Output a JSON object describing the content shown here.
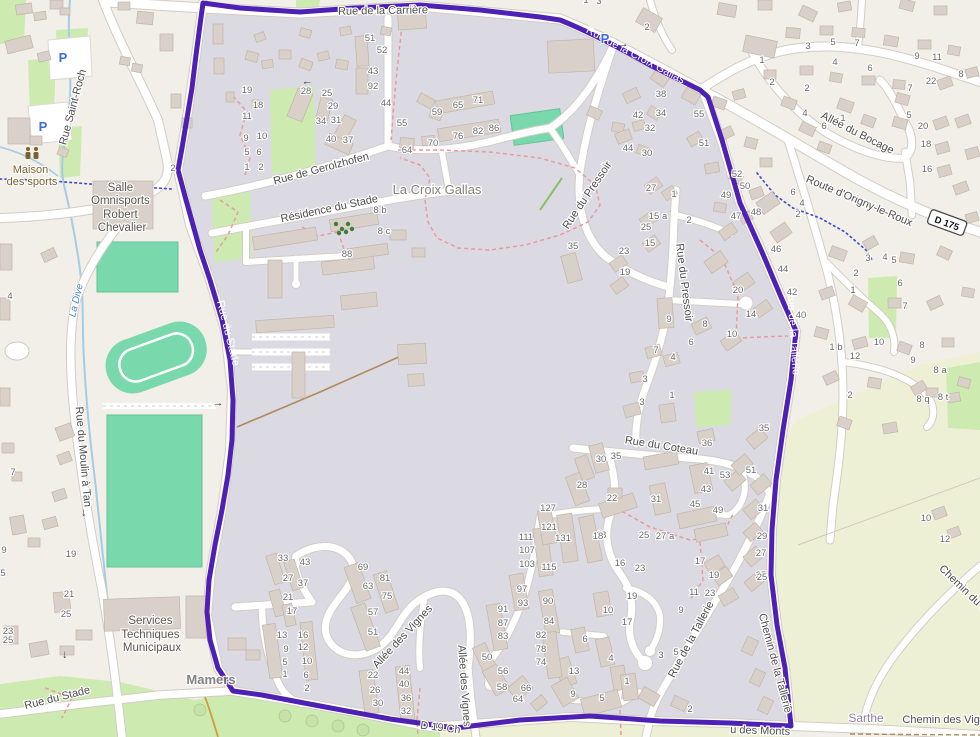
{
  "map": {
    "title": "Carte OpenStreetMap - Mamers, limite communale surlignée",
    "colors": {
      "land": "#f2efe9",
      "residential": "#dbdae2",
      "farmland": "#eef0d5",
      "grass": "#cdebb0",
      "pitch": "#79d9ad",
      "pitch_edge": "#62c296",
      "building": "#d9d0c9",
      "building_edge": "#c3b5a6",
      "road": "#ffffff",
      "road_casing": "#d2cdc4",
      "boundary": "#4e21b4",
      "water": "#a6cbe4",
      "footpath_red": "#ea9a9a",
      "admin_blue": "#4050cc",
      "track_brown": "#b08a5a",
      "path_ochre": "#cf9e3e",
      "number": "#6b6b6b",
      "street_text": "#4d4d4d",
      "tree_dark": "#3f7d36",
      "tree_pale": "#c8e0aa"
    },
    "road_ref": {
      "text": "D 175",
      "x": 947,
      "y": 223,
      "rot": 20
    },
    "place_label": {
      "text": "La Croix Gallas",
      "x": 437,
      "y": 194
    },
    "admin_labels": [
      {
        "text": "Mamers",
        "x": 211,
        "y": 684
      },
      {
        "text": "Sarthe",
        "x": 866,
        "y": 722
      }
    ],
    "water_label": {
      "text": "La Dive",
      "x": 79,
      "y": 301,
      "rot": -77
    },
    "poi": {
      "maison_sports": {
        "lines": [
          "Maison",
          "des sports"
        ],
        "x": 32,
        "ys": [
          173,
          185
        ]
      },
      "salle_omnisports": {
        "lines": [
          "Salle",
          "Omnisports",
          "Robert",
          "Chevalier"
        ],
        "x": 122,
        "ys": [
          191,
          204,
          218,
          231
        ]
      },
      "services_techniques": {
        "lines": [
          "Services",
          "Techniques",
          "Municipaux"
        ],
        "x": 152,
        "ys": [
          624,
          638,
          651
        ]
      }
    },
    "street_labels": [
      {
        "text": "Rue de la Carrière",
        "x": 383,
        "y": 14,
        "r": -1
      },
      {
        "text": "Rue de la Croix Gallas",
        "x": 634,
        "y": 58,
        "r": 28,
        "c": "white"
      },
      {
        "text": "Rue Saint-Roch",
        "x": 76,
        "y": 108,
        "r": -75
      },
      {
        "text": "Allée du Bocage",
        "x": 856,
        "y": 136,
        "r": 27
      },
      {
        "text": "Route d'Origny-le-Roux",
        "x": 858,
        "y": 204,
        "r": 23
      },
      {
        "text": "Rue de Gerolzhofen",
        "x": 322,
        "y": 172,
        "r": -15
      },
      {
        "text": "Résidence du Stade",
        "x": 330,
        "y": 212,
        "r": -12
      },
      {
        "text": "Rue du Pressoir",
        "x": 590,
        "y": 197,
        "r": -56
      },
      {
        "text": "Rue du Pressoir",
        "x": 681,
        "y": 283,
        "r": 83
      },
      {
        "text": "Rue du Coteau",
        "x": 661,
        "y": 449,
        "r": 9
      },
      {
        "text": "Rue de la Tallerie",
        "x": 790,
        "y": 333,
        "r": 86,
        "c": "white"
      },
      {
        "text": "Rue de la Tallerie",
        "x": 694,
        "y": 641,
        "r": -62
      },
      {
        "text": "Chemin de la Tallerie",
        "x": 772,
        "y": 664,
        "r": 75
      },
      {
        "text": "Allée des Vignes",
        "x": 405,
        "y": 639,
        "r": -47
      },
      {
        "text": "Allée des Vignes",
        "x": 461,
        "y": 686,
        "r": 86
      },
      {
        "text": "Rue du Moulin à Tan",
        "x": 80,
        "y": 457,
        "r": 85
      },
      {
        "text": "Rue du Stade",
        "x": 225,
        "y": 334,
        "r": 76,
        "c": "white"
      },
      {
        "text": "Rue du Stade",
        "x": 58,
        "y": 701,
        "r": -14
      },
      {
        "text": "Chemin des Vignes",
        "x": 950,
        "y": 723,
        "r": 0
      },
      {
        "text": "Chemin du M",
        "x": 962,
        "y": 592,
        "r": 44
      },
      {
        "text": "D 19 Ch",
        "x": 440,
        "y": 731,
        "r": 7
      },
      {
        "text": "u des Monts",
        "x": 760,
        "y": 734,
        "r": 2
      }
    ],
    "parking_icons": [
      {
        "x": 63,
        "y": 62
      },
      {
        "x": 43,
        "y": 131
      },
      {
        "x": 605,
        "y": 43
      }
    ],
    "oneway_arrows": [
      {
        "x": 307,
        "y": 81,
        "r": 180
      },
      {
        "x": 623,
        "y": 47,
        "r": 0
      },
      {
        "x": 82,
        "y": 513,
        "r": 90
      },
      {
        "x": 63,
        "y": 655,
        "r": 90
      },
      {
        "x": 218,
        "y": 406,
        "r": 0
      }
    ],
    "house_numbers": [
      [
        "19",
        247,
        93
      ],
      [
        "18",
        258,
        108
      ],
      [
        "11",
        247,
        119
      ],
      [
        "9",
        246,
        141
      ],
      [
        "10",
        262,
        139
      ],
      [
        "5",
        247,
        155
      ],
      [
        "6",
        259,
        155
      ],
      [
        "1",
        247,
        170
      ],
      [
        "2",
        261,
        170
      ],
      [
        "28",
        306,
        94
      ],
      [
        "25",
        327,
        96
      ],
      [
        "29",
        333,
        109
      ],
      [
        "34",
        321,
        124
      ],
      [
        "31",
        336,
        123
      ],
      [
        "40",
        331,
        142
      ],
      [
        "37",
        348,
        143
      ],
      [
        "51",
        370,
        41
      ],
      [
        "52",
        382,
        53
      ],
      [
        "43",
        373,
        74
      ],
      [
        "92",
        373,
        89
      ],
      [
        "44",
        386,
        106
      ],
      [
        "55",
        402,
        126
      ],
      [
        "64",
        407,
        153
      ],
      [
        "70",
        433,
        146
      ],
      [
        "76",
        458,
        139
      ],
      [
        "82",
        478,
        134
      ],
      [
        "86",
        494,
        131
      ],
      [
        "59",
        437,
        115
      ],
      [
        "65",
        458,
        108
      ],
      [
        "71",
        478,
        103
      ],
      [
        "1",
        586,
        3
      ],
      [
        "3",
        599,
        4
      ],
      [
        "2",
        647,
        30
      ],
      [
        "1",
        762,
        63
      ],
      [
        "2",
        772,
        85
      ],
      [
        "2",
        173,
        171
      ],
      [
        "38",
        661,
        97
      ],
      [
        "42",
        638,
        118
      ],
      [
        "34",
        661,
        116
      ],
      [
        "32",
        650,
        131
      ],
      [
        "44",
        628,
        151
      ],
      [
        "30",
        647,
        156
      ],
      [
        "55",
        699,
        117
      ],
      [
        "51",
        704,
        146
      ],
      [
        "52",
        737,
        177
      ],
      [
        "50",
        745,
        189
      ],
      [
        "49",
        726,
        198
      ],
      [
        "47",
        736,
        219
      ],
      [
        "48",
        756,
        215
      ],
      [
        "46",
        776,
        252
      ],
      [
        "44",
        783,
        272
      ],
      [
        "42",
        792,
        295
      ],
      [
        "40",
        801,
        318
      ],
      [
        "3",
        808,
        49
      ],
      [
        "5",
        833,
        45
      ],
      [
        "7",
        857,
        46
      ],
      [
        "9",
        917,
        59
      ],
      [
        "11",
        937,
        60
      ],
      [
        "4",
        835,
        65
      ],
      [
        "6",
        870,
        71
      ],
      [
        "8",
        961,
        77
      ],
      [
        "2",
        807,
        91
      ],
      [
        "22",
        931,
        84
      ],
      [
        "7",
        910,
        91
      ],
      [
        "4",
        805,
        116
      ],
      [
        "1",
        843,
        121
      ],
      [
        "5",
        909,
        118
      ],
      [
        "6",
        824,
        129
      ],
      [
        "20",
        923,
        129
      ],
      [
        "18",
        926,
        147
      ],
      [
        "16",
        927,
        172
      ],
      [
        "3",
        868,
        261
      ],
      [
        "4",
        885,
        260
      ],
      [
        "5",
        894,
        263
      ],
      [
        "2",
        856,
        276
      ],
      [
        "1",
        853,
        293
      ],
      [
        "6",
        793,
        195
      ],
      [
        "4",
        802,
        206
      ],
      [
        "2",
        798,
        217
      ],
      [
        "6",
        900,
        286
      ],
      [
        "7",
        905,
        309
      ],
      [
        "8",
        922,
        348
      ],
      [
        "9",
        913,
        363
      ],
      [
        "8 a",
        940,
        373
      ],
      [
        "8 q",
        923,
        402
      ],
      [
        "8 t",
        943,
        400
      ],
      [
        "1 b",
        836,
        350
      ],
      [
        "10",
        879,
        345
      ],
      [
        "12",
        855,
        359
      ],
      [
        "2",
        850,
        398
      ],
      [
        "10",
        926,
        521
      ],
      [
        "12",
        945,
        542
      ],
      [
        "25",
        761,
        578
      ],
      [
        "27",
        651,
        191
      ],
      [
        "1",
        674,
        197
      ],
      [
        "15 a",
        658,
        219
      ],
      [
        "25",
        646,
        230
      ],
      [
        "15",
        650,
        246
      ],
      [
        "23",
        624,
        254
      ],
      [
        "19",
        625,
        275
      ],
      [
        "35",
        573,
        249
      ],
      [
        "2",
        689,
        223
      ],
      [
        "20",
        738,
        293
      ],
      [
        "14",
        751,
        317
      ],
      [
        "10",
        732,
        337
      ],
      [
        "9",
        669,
        322
      ],
      [
        "8",
        705,
        327
      ],
      [
        "7",
        656,
        353
      ],
      [
        "4",
        673,
        360
      ],
      [
        "6",
        691,
        345
      ],
      [
        "3",
        645,
        382
      ],
      [
        "3",
        642,
        405
      ],
      [
        "1",
        672,
        398
      ],
      [
        "30",
        601,
        462
      ],
      [
        "35",
        616,
        459
      ],
      [
        "36",
        707,
        446
      ],
      [
        "41",
        709,
        474
      ],
      [
        "53",
        725,
        478
      ],
      [
        "51",
        751,
        473
      ],
      [
        "43",
        706,
        492
      ],
      [
        "35",
        764,
        431
      ],
      [
        "28",
        582,
        488
      ],
      [
        "22",
        612,
        501
      ],
      [
        "31",
        656,
        502
      ],
      [
        "45",
        695,
        507
      ],
      [
        "49",
        718,
        513
      ],
      [
        "31",
        763,
        511
      ],
      [
        "29",
        762,
        539
      ],
      [
        "27",
        761,
        556
      ],
      [
        "25",
        762,
        580
      ],
      [
        "18",
        601,
        538
      ],
      [
        "16",
        620,
        566
      ],
      [
        "25",
        644,
        538
      ],
      [
        "27 a",
        665,
        539
      ],
      [
        "23",
        640,
        571
      ],
      [
        "17",
        700,
        564
      ],
      [
        "19",
        714,
        578
      ],
      [
        "11",
        694,
        595
      ],
      [
        "23",
        710,
        596
      ],
      [
        "19",
        632,
        599
      ],
      [
        "10",
        608,
        613
      ],
      [
        "17",
        627,
        625
      ],
      [
        "33",
        283,
        561
      ],
      [
        "43",
        305,
        565
      ],
      [
        "27",
        288,
        581
      ],
      [
        "37",
        303,
        586
      ],
      [
        "21",
        288,
        600
      ],
      [
        "17",
        292,
        614
      ],
      [
        "69",
        363,
        570
      ],
      [
        "63",
        368,
        589
      ],
      [
        "81",
        385,
        581
      ],
      [
        "75",
        387,
        599
      ],
      [
        "57",
        373,
        615
      ],
      [
        "51",
        373,
        635
      ],
      [
        "13",
        282,
        638
      ],
      [
        "16",
        303,
        638
      ],
      [
        "9",
        286,
        652
      ],
      [
        "12",
        303,
        650
      ],
      [
        "5",
        285,
        665
      ],
      [
        "10",
        307,
        664
      ],
      [
        "1",
        285,
        677
      ],
      [
        "6",
        306,
        678
      ],
      [
        "2",
        307,
        691
      ],
      [
        "22",
        373,
        678
      ],
      [
        "26",
        375,
        693
      ],
      [
        "30",
        378,
        706
      ],
      [
        "44",
        404,
        674
      ],
      [
        "40",
        404,
        687
      ],
      [
        "36",
        406,
        701
      ],
      [
        "32",
        406,
        714
      ],
      [
        "127",
        548,
        511
      ],
      [
        "121",
        549,
        530
      ],
      [
        "111",
        526,
        540
      ],
      [
        "131",
        563,
        541
      ],
      [
        "107",
        527,
        553
      ],
      [
        "103",
        527,
        567
      ],
      [
        "115",
        549,
        570
      ],
      [
        "18",
        598,
        539
      ],
      [
        "97",
        522,
        592
      ],
      [
        "93",
        523,
        606
      ],
      [
        "91",
        503,
        612
      ],
      [
        "87",
        503,
        626
      ],
      [
        "83",
        503,
        639
      ],
      [
        "90",
        548,
        604
      ],
      [
        "84",
        549,
        624
      ],
      [
        "82",
        541,
        638
      ],
      [
        "78",
        541,
        652
      ],
      [
        "74",
        541,
        665
      ],
      [
        "50",
        487,
        660
      ],
      [
        "56",
        503,
        674
      ],
      [
        "58",
        502,
        690
      ],
      [
        "66",
        526,
        691
      ],
      [
        "64",
        518,
        702
      ],
      [
        "6",
        585,
        642
      ],
      [
        "4",
        611,
        661
      ],
      [
        "13",
        574,
        674
      ],
      [
        "1",
        627,
        684
      ],
      [
        "9",
        573,
        697
      ],
      [
        "5",
        602,
        701
      ],
      [
        "3",
        661,
        658
      ],
      [
        "5",
        676,
        655
      ],
      [
        "9",
        681,
        613
      ],
      [
        "2",
        690,
        712
      ],
      [
        "21",
        69,
        597
      ],
      [
        "25",
        66,
        617
      ],
      [
        "23",
        8,
        634
      ],
      [
        "25",
        8,
        643
      ],
      [
        "19",
        71,
        557
      ],
      [
        "7",
        13,
        475
      ],
      [
        "9",
        4,
        553
      ],
      [
        "5",
        3,
        576
      ],
      [
        "4",
        10,
        299
      ],
      [
        "8 b",
        380,
        213
      ],
      [
        "8 c",
        384,
        234
      ],
      [
        "88",
        347,
        257
      ]
    ]
  }
}
